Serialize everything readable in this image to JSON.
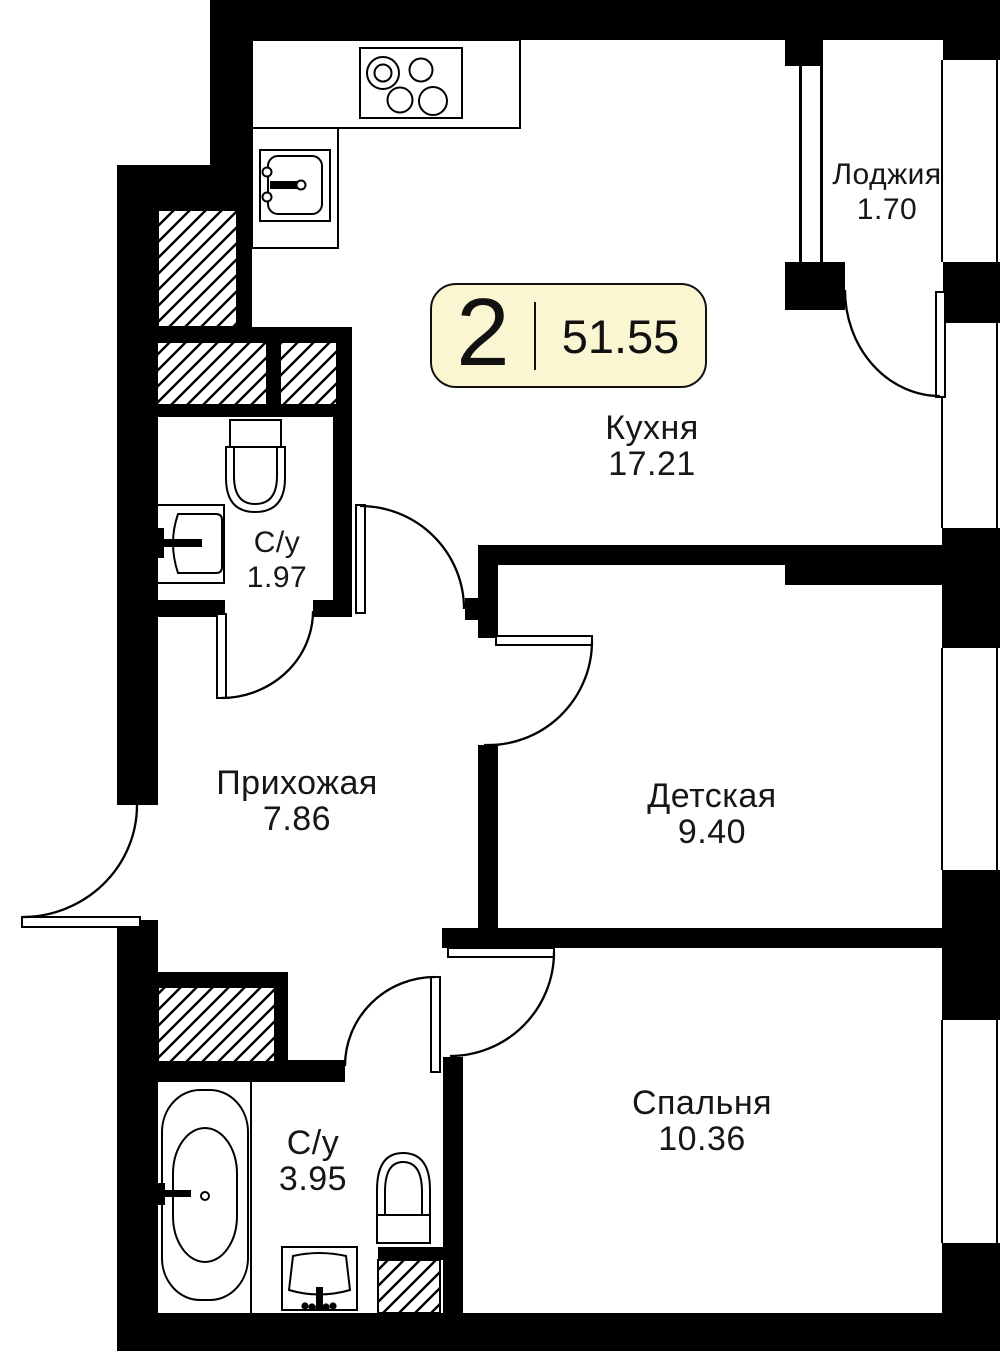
{
  "plan": {
    "rooms_count": "2",
    "total_area": "51.55"
  },
  "rooms": [
    {
      "name": "Кухня",
      "area": "17.21"
    },
    {
      "name": "Лоджия",
      "area": "1.70"
    },
    {
      "name": "С/у",
      "area": "1.97"
    },
    {
      "name": "Прихожая",
      "area": "7.86"
    },
    {
      "name": "Детская",
      "area": "9.40"
    },
    {
      "name": "С/у",
      "area": "3.95"
    },
    {
      "name": "Спальня",
      "area": "10.36"
    }
  ],
  "colors": {
    "wall": "#000000",
    "badge_fill": "#FAF6D2",
    "line": "#111111"
  },
  "icons": [
    "stove-icon",
    "kitchen-sink-icon",
    "toilet-icon",
    "washbasin-icon",
    "bathtub-icon",
    "ventilation-shaft-hatch",
    "door-swing-arc",
    "window-glazing"
  ]
}
